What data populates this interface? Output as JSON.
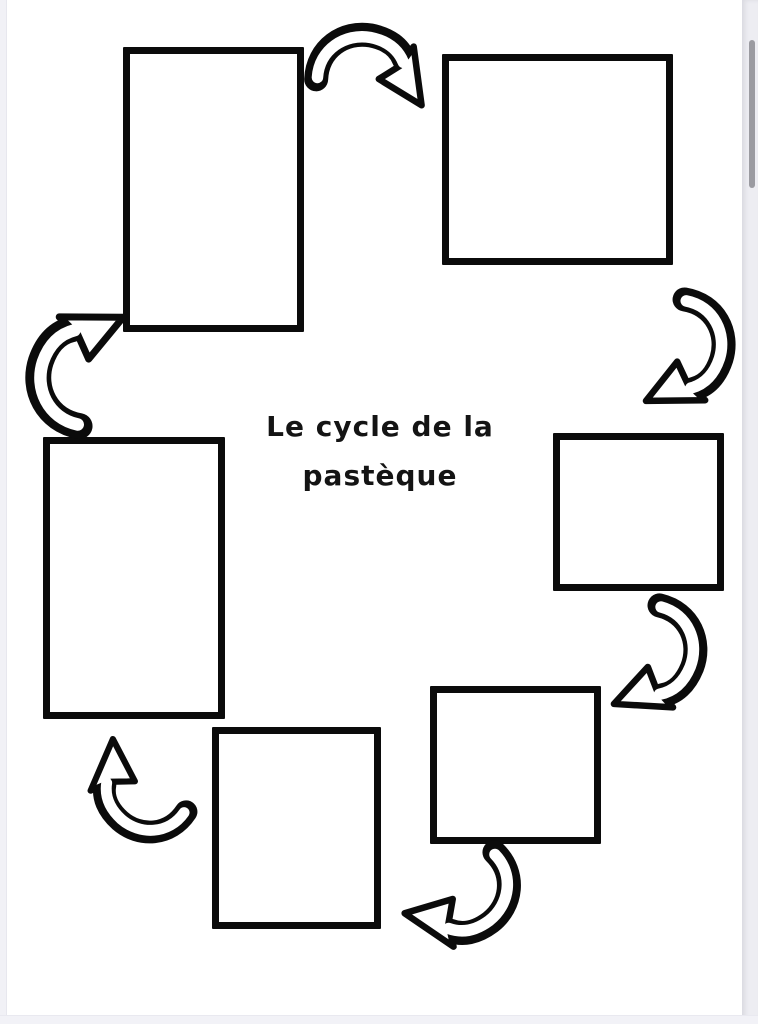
{
  "viewer": {
    "scrollbar_color": "#9b9ba1",
    "edge_strip_color": "#ededf2",
    "bottom_strip_color": "#f2f2f7",
    "paper_color": "#ffffff"
  },
  "worksheet": {
    "title": "Le cycle de la pastèque",
    "title_line1": "Le cycle de la",
    "title_line2": "pastèque",
    "ink_color": "#0b0b0b",
    "cycle_direction": "clockwise",
    "box_count": 6,
    "boxes": [
      {
        "position": "top-left",
        "label": ""
      },
      {
        "position": "top-right",
        "label": ""
      },
      {
        "position": "right",
        "label": ""
      },
      {
        "position": "bottom-right",
        "label": ""
      },
      {
        "position": "bottom",
        "label": ""
      },
      {
        "position": "left",
        "label": ""
      }
    ],
    "arrows": [
      {
        "from": "top-left",
        "to": "top-right"
      },
      {
        "from": "top-right",
        "to": "right"
      },
      {
        "from": "right",
        "to": "bottom-right"
      },
      {
        "from": "bottom-right",
        "to": "bottom"
      },
      {
        "from": "bottom",
        "to": "left"
      },
      {
        "from": "left",
        "to": "top-left"
      }
    ]
  }
}
